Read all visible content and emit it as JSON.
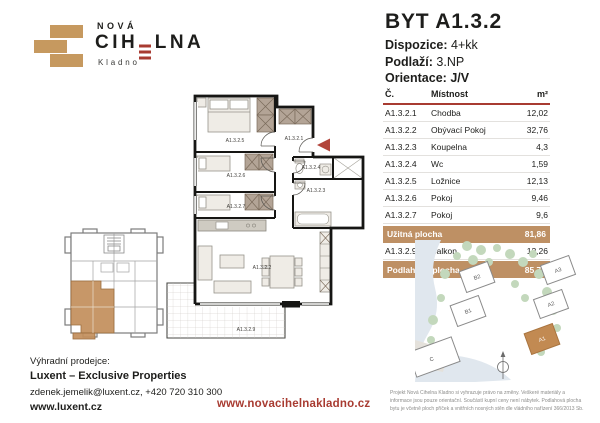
{
  "colors": {
    "brand_tan": "#C6995F",
    "brand_red": "#A83B31",
    "table_highlight": "#BE9064",
    "site_highlight_building": "#C28A52"
  },
  "logo": {
    "line1": "NOVÁ",
    "main_left": "CIH",
    "main_right": "LNA",
    "city": "Kladno"
  },
  "unit": {
    "title": "BYT A1.3.2",
    "dispozice_label": "Dispozice:",
    "dispozice_value": "4+kk",
    "podlazi_label": "Podlaží:",
    "podlazi_value": "3.NP",
    "orientace_label": "Orientace:",
    "orientace_value": "J/V"
  },
  "table": {
    "headers": {
      "no": "Č.",
      "room": "Místnost",
      "area": "m²"
    },
    "rows": [
      {
        "no": "A1.3.2.1",
        "room": "Chodba",
        "area": "12,02"
      },
      {
        "no": "A1.3.2.2",
        "room": "Obývací Pokoj",
        "area": "32,76"
      },
      {
        "no": "A1.3.2.3",
        "room": "Koupelna",
        "area": "4,3"
      },
      {
        "no": "A1.3.2.4",
        "room": "Wc",
        "area": "1,59"
      },
      {
        "no": "A1.3.2.5",
        "room": "Ložnice",
        "area": "12,13"
      },
      {
        "no": "A1.3.2.6",
        "room": "Pokoj",
        "area": "9,46"
      },
      {
        "no": "A1.3.2.7",
        "room": "Pokoj",
        "area": "9,6"
      }
    ],
    "usable": {
      "label": "Užitná plocha",
      "area": "81,86"
    },
    "balcony": {
      "no": "A1.3.2.9",
      "room": "Balkon",
      "area": "12,26"
    },
    "floor_total": {
      "label": "Podlahová plocha",
      "area": "85,75"
    }
  },
  "floorplan": {
    "labels": {
      "hall": "A1.3.2.1",
      "living": "A1.3.2.2",
      "bath": "A1.3.2.3",
      "wc": "A1.3.2.4",
      "bedroom": "A1.3.2.5",
      "room1": "A1.3.2.6",
      "room2": "A1.3.2.7",
      "balcony": "A1.3.2.9"
    }
  },
  "siteplan": {
    "buildings": [
      "B2",
      "B1",
      "A3",
      "A2",
      "A1",
      "C"
    ]
  },
  "contact": {
    "heading": "Výhradní prodejce:",
    "company": "Luxent – Exclusive Properties",
    "details": "zdenek.jemelik@luxent.cz, +420 720 310 300",
    "website": "www.luxent.cz"
  },
  "footer": {
    "project_url": "www.novacihelnakladno.cz",
    "disclaimer": "Projekt Nová Cihelna Kladno si vyhrazuje právo na změny. Veškeré materiály a informace jsou pouze orientační. Součástí kupní ceny není nábytek. Podlahová plocha bytu je včetně ploch příček a vnitřních nosných stěn dle vládního nařízení 366/2013 Sb."
  }
}
